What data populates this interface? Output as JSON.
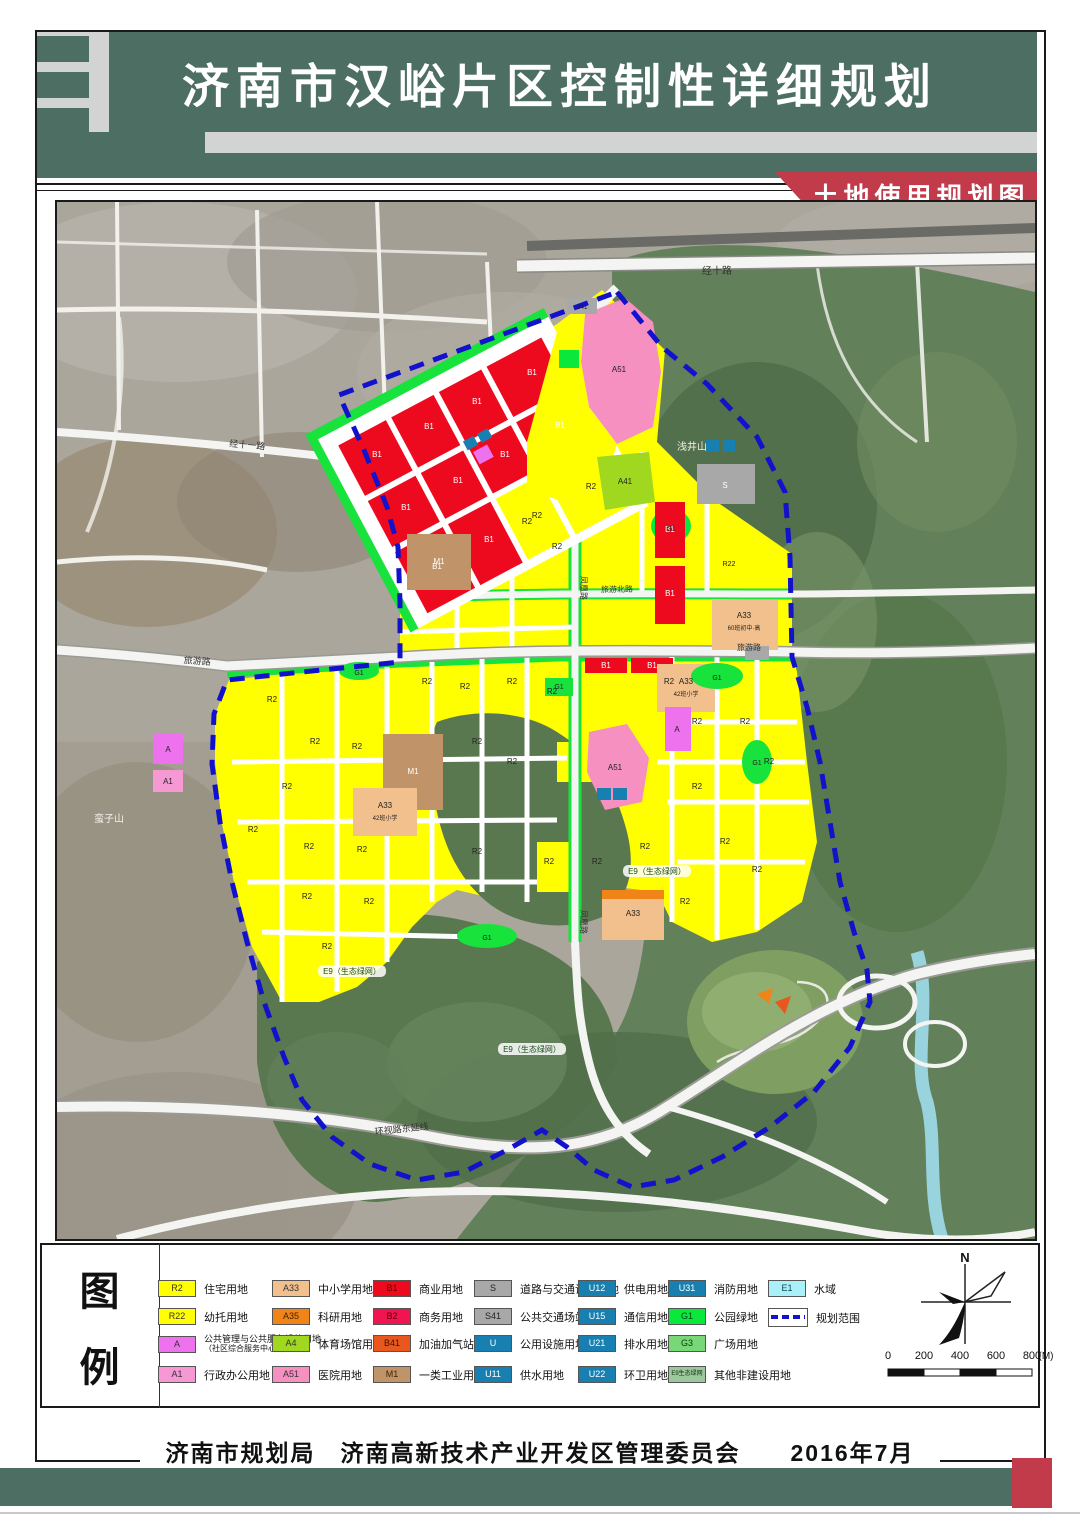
{
  "header": {
    "title": "济南市汉峪片区控制性详细规划",
    "banner": "土地使用规划图"
  },
  "colors": {
    "header_green": "#4c6e63",
    "banner_red": "#c13b4b",
    "boundary_blue": "#1212cc",
    "residential_yellow": "#ffff00",
    "forest_green": "#5a7850"
  },
  "legend": {
    "heading": [
      "图",
      "例"
    ],
    "boundary_item": {
      "label": "规划范围"
    },
    "items": [
      {
        "col": 0,
        "row": 0,
        "code": "R2",
        "color": "#ffff00",
        "text": "#333333",
        "label": "住宅用地"
      },
      {
        "col": 0,
        "row": 1,
        "code": "R22",
        "color": "#ffff00",
        "text": "#333333",
        "label": "幼托用地"
      },
      {
        "col": 0,
        "row": 2,
        "code": "A",
        "color": "#ee72ee",
        "text": "#333333",
        "label": "公共管理与公共服务设施用地",
        "label2": "（社区综合服务中心）"
      },
      {
        "col": 0,
        "row": 3,
        "code": "A1",
        "color": "#f598d4",
        "text": "#333333",
        "label": "行政办公用地"
      },
      {
        "col": 1,
        "row": 0,
        "code": "A33",
        "color": "#f2c08c",
        "text": "#333333",
        "label": "中小学用地"
      },
      {
        "col": 1,
        "row": 1,
        "code": "A35",
        "color": "#f08418",
        "text": "#442200",
        "label": "科研用地"
      },
      {
        "col": 1,
        "row": 2,
        "code": "A4",
        "color": "#a0d820",
        "text": "#333333",
        "label": "体育场馆用地"
      },
      {
        "col": 1,
        "row": 3,
        "code": "A51",
        "color": "#f590c0",
        "text": "#333333",
        "label": "医院用地"
      },
      {
        "col": 2,
        "row": 0,
        "code": "B1",
        "color": "#ee0a1e",
        "text": "#5a0000",
        "label": "商业用地"
      },
      {
        "col": 2,
        "row": 1,
        "code": "B2",
        "color": "#f01450",
        "text": "#5a0000",
        "label": "商务用地"
      },
      {
        "col": 2,
        "row": 2,
        "code": "B41",
        "color": "#e8581e",
        "text": "#441100",
        "label": "加油加气站用地"
      },
      {
        "col": 2,
        "row": 3,
        "code": "M1",
        "color": "#c09468",
        "text": "#3a2200",
        "label": "一类工业用地"
      },
      {
        "col": 3,
        "row": 0,
        "code": "S",
        "color": "#a8a8a8",
        "text": "#222222",
        "label": "道路与交通设施用地"
      },
      {
        "col": 3,
        "row": 1,
        "code": "S41",
        "color": "#a8a8a8",
        "text": "#222222",
        "label": "公共交通场站用地"
      },
      {
        "col": 3,
        "row": 2,
        "code": "U",
        "color": "#1880b0",
        "text": "#ffffff",
        "label": "公用设施用地"
      },
      {
        "col": 3,
        "row": 3,
        "code": "U11",
        "color": "#1880b0",
        "text": "#ffffff",
        "label": "供水用地"
      },
      {
        "col": 4,
        "row": 0,
        "code": "U12",
        "color": "#1880b0",
        "text": "#ffffff",
        "label": "供电用地"
      },
      {
        "col": 4,
        "row": 1,
        "code": "U15",
        "color": "#1880b0",
        "text": "#ffffff",
        "label": "通信用地"
      },
      {
        "col": 4,
        "row": 2,
        "code": "U21",
        "color": "#1880b0",
        "text": "#ffffff",
        "label": "排水用地"
      },
      {
        "col": 4,
        "row": 3,
        "code": "U22",
        "color": "#1880b0",
        "text": "#ffffff",
        "label": "环卫用地"
      },
      {
        "col": 5,
        "row": 0,
        "code": "U31",
        "color": "#1880b0",
        "text": "#ffffff",
        "label": "消防用地"
      },
      {
        "col": 5,
        "row": 1,
        "code": "G1",
        "color": "#0ae83c",
        "text": "#064016",
        "label": "公园绿地"
      },
      {
        "col": 5,
        "row": 2,
        "code": "G3",
        "color": "#78d878",
        "text": "#0a3a0a",
        "label": "广场用地"
      },
      {
        "col": 5,
        "row": 3,
        "code": "E9生态绿网",
        "color": "#9cc89c",
        "text": "#143014",
        "label": "其他非建设用地",
        "small_code": true
      },
      {
        "col": 6,
        "row": 0,
        "code": "E1",
        "color": "#aaf0f8",
        "text": "#114455",
        "label": "水域"
      }
    ]
  },
  "scalebar": {
    "ticks": [
      "0",
      "200",
      "400",
      "600",
      "800"
    ],
    "unit": "(M)"
  },
  "north": {
    "label": "N"
  },
  "footer": {
    "text": "济南市规划局　济南高新技术产业开发区管理委员会　　2016年7月"
  },
  "map": {
    "road_labels": [
      {
        "text": "经十路",
        "x": 660,
        "y": 72,
        "rot": -1,
        "size": 10,
        "fill": "#333333"
      },
      {
        "text": "经十一路",
        "x": 190,
        "y": 246,
        "rot": 5,
        "size": 9,
        "fill": "#333333"
      },
      {
        "text": "旅游北路",
        "x": 560,
        "y": 390,
        "rot": -1,
        "size": 8,
        "fill": "#333333"
      },
      {
        "text": "旅游路",
        "x": 140,
        "y": 462,
        "rot": 4,
        "size": 9,
        "fill": "#333333"
      },
      {
        "text": "旅游路",
        "x": 692,
        "y": 448,
        "rot": 0,
        "size": 8,
        "fill": "#333333"
      },
      {
        "text": "凤凰路",
        "x": 524,
        "y": 386,
        "rot": 90,
        "size": 8,
        "fill": "#333333"
      },
      {
        "text": "凤凰路",
        "x": 524,
        "y": 720,
        "rot": 90,
        "size": 8,
        "fill": "#333333"
      },
      {
        "text": "环视路东延线",
        "x": 345,
        "y": 930,
        "rot": -6,
        "size": 9,
        "fill": "#333333"
      }
    ],
    "area_labels": [
      {
        "text": "浅井山",
        "x": 635,
        "y": 248,
        "size": 10,
        "fill": "#f2f2ea"
      },
      {
        "text": "蛮子山",
        "x": 52,
        "y": 620,
        "size": 10,
        "fill": "#f2f2ea"
      }
    ],
    "eco_labels": [
      {
        "text": "E9（生态绿网）",
        "x": 295,
        "y": 772
      },
      {
        "text": "E9（生态绿网）",
        "x": 475,
        "y": 850
      },
      {
        "text": "E9（生态绿网）",
        "x": 600,
        "y": 672
      }
    ],
    "parcel_labels": [
      {
        "text": "B1",
        "x": 320,
        "y": 255,
        "fill": "#ffffff"
      },
      {
        "text": "B1",
        "x": 372,
        "y": 227,
        "fill": "#ffffff"
      },
      {
        "text": "B1",
        "x": 420,
        "y": 202,
        "fill": "#ffffff"
      },
      {
        "text": "B1",
        "x": 475,
        "y": 173,
        "fill": "#ffffff"
      },
      {
        "text": "B1",
        "x": 349,
        "y": 308,
        "fill": "#ffffff"
      },
      {
        "text": "B1",
        "x": 401,
        "y": 281,
        "fill": "#ffffff"
      },
      {
        "text": "B1",
        "x": 448,
        "y": 255,
        "fill": "#ffffff"
      },
      {
        "text": "B1",
        "x": 503,
        "y": 226,
        "fill": "#ffffff"
      },
      {
        "text": "B1",
        "x": 380,
        "y": 367,
        "fill": "#ffffff"
      },
      {
        "text": "B1",
        "x": 432,
        "y": 340,
        "fill": "#ffffff"
      },
      {
        "text": "R2",
        "x": 480,
        "y": 316
      },
      {
        "text": "R2",
        "x": 534,
        "y": 287
      },
      {
        "text": "B1",
        "x": 613,
        "y": 330,
        "fill": "#ffffff"
      },
      {
        "text": "B1",
        "x": 613,
        "y": 394,
        "fill": "#ffffff"
      },
      {
        "text": "B1",
        "x": 549,
        "y": 466,
        "fill": "#ffffff"
      },
      {
        "text": "B1",
        "x": 595,
        "y": 466,
        "fill": "#ffffff"
      },
      {
        "text": "A51",
        "x": 562,
        "y": 170
      },
      {
        "text": "A41",
        "x": 568,
        "y": 282
      },
      {
        "text": "S41",
        "x": 525,
        "y": 107,
        "size": 6
      },
      {
        "text": "S",
        "x": 668,
        "y": 286,
        "fill": "#ffffff"
      },
      {
        "text": "M1",
        "x": 382,
        "y": 362,
        "fill": "#ffffff"
      },
      {
        "text": "M1",
        "x": 356,
        "y": 572,
        "fill": "#ffffff"
      },
      {
        "text": "A33",
        "x": 687,
        "y": 416
      },
      {
        "text": "60班初中·高",
        "x": 687,
        "y": 428,
        "size": 6
      },
      {
        "text": "A33",
        "x": 629,
        "y": 482
      },
      {
        "text": "42班小学",
        "x": 629,
        "y": 494,
        "size": 6
      },
      {
        "text": "A33",
        "x": 328,
        "y": 606
      },
      {
        "text": "42班小学",
        "x": 328,
        "y": 618,
        "size": 6
      },
      {
        "text": "A33",
        "x": 576,
        "y": 714
      },
      {
        "text": "A51",
        "x": 558,
        "y": 568
      },
      {
        "text": "A",
        "x": 620,
        "y": 530
      },
      {
        "text": "A",
        "x": 111,
        "y": 550
      },
      {
        "text": "A1",
        "x": 111,
        "y": 582
      },
      {
        "text": "R22",
        "x": 672,
        "y": 364,
        "size": 7
      },
      {
        "text": "G1",
        "x": 660,
        "y": 478,
        "size": 7
      },
      {
        "text": "G1",
        "x": 700,
        "y": 563,
        "size": 7
      },
      {
        "text": "G1",
        "x": 302,
        "y": 473,
        "size": 7
      },
      {
        "text": "G1",
        "x": 502,
        "y": 487,
        "size": 7
      },
      {
        "text": "G1",
        "x": 430,
        "y": 738,
        "size": 7
      },
      {
        "text": "G1",
        "x": 614,
        "y": 329,
        "size": 7
      },
      {
        "text": "R2",
        "x": 215,
        "y": 500
      },
      {
        "text": "R2",
        "x": 258,
        "y": 542
      },
      {
        "text": "R2",
        "x": 300,
        "y": 547
      },
      {
        "text": "R2",
        "x": 230,
        "y": 587
      },
      {
        "text": "R2",
        "x": 196,
        "y": 630
      },
      {
        "text": "R2",
        "x": 252,
        "y": 647
      },
      {
        "text": "R2",
        "x": 305,
        "y": 650
      },
      {
        "text": "R2",
        "x": 250,
        "y": 697
      },
      {
        "text": "R2",
        "x": 312,
        "y": 702
      },
      {
        "text": "R2",
        "x": 270,
        "y": 747
      },
      {
        "text": "R2",
        "x": 370,
        "y": 482
      },
      {
        "text": "R2",
        "x": 408,
        "y": 487
      },
      {
        "text": "R2",
        "x": 455,
        "y": 482
      },
      {
        "text": "R2",
        "x": 495,
        "y": 492
      },
      {
        "text": "R2",
        "x": 420,
        "y": 542
      },
      {
        "text": "R2",
        "x": 455,
        "y": 562
      },
      {
        "text": "R2",
        "x": 420,
        "y": 652
      },
      {
        "text": "R2",
        "x": 492,
        "y": 662
      },
      {
        "text": "R2",
        "x": 540,
        "y": 662
      },
      {
        "text": "R2",
        "x": 612,
        "y": 482
      },
      {
        "text": "R2",
        "x": 640,
        "y": 522
      },
      {
        "text": "R2",
        "x": 688,
        "y": 522
      },
      {
        "text": "R2",
        "x": 712,
        "y": 562
      },
      {
        "text": "R2",
        "x": 640,
        "y": 587
      },
      {
        "text": "R2",
        "x": 668,
        "y": 642
      },
      {
        "text": "R2",
        "x": 700,
        "y": 670
      },
      {
        "text": "R2",
        "x": 628,
        "y": 702
      },
      {
        "text": "R2",
        "x": 588,
        "y": 647
      },
      {
        "text": "R2",
        "x": 470,
        "y": 322
      },
      {
        "text": "R2",
        "x": 500,
        "y": 347
      }
    ]
  }
}
